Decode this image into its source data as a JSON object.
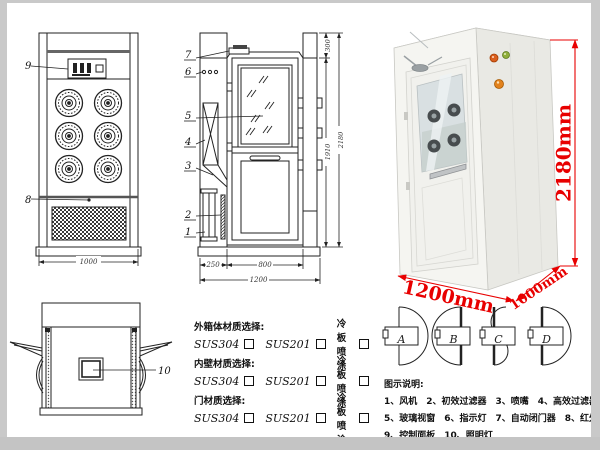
{
  "colors": {
    "red_dim": "#e80000",
    "line": "#222222",
    "frame_gray": "#c9c9c9",
    "glass": "#d9e0e2",
    "button_orange": "#d95f1e",
    "button_green": "#8fae3a",
    "button_amber": "#e2821d"
  },
  "callouts": {
    "c1": "1",
    "c2": "2",
    "c3": "3",
    "c4": "4",
    "c5": "5",
    "c6": "6",
    "c7": "7",
    "c8": "8",
    "c9": "9",
    "c10": "10"
  },
  "front_view": {
    "width_dim": "1000"
  },
  "section_view": {
    "top_dim": "300",
    "door_height_dim": "1910",
    "total_height_dim": "2180",
    "left_dim": "250",
    "door_width_dim": "800",
    "total_width_dim": "1200"
  },
  "photo": {
    "height_label": "2180mm",
    "width_label": "1200mm",
    "depth_label": "1000mm"
  },
  "materials": {
    "groups": [
      {
        "title": "外箱体材质选择:",
        "options": [
          "SUS304",
          "SUS201",
          "冷板喷涂"
        ]
      },
      {
        "title": "内壁材质选择:",
        "options": [
          "SUS304",
          "SUS201",
          "冷板喷涂"
        ]
      },
      {
        "title": "门材质选择:",
        "options": [
          "SUS304",
          "SUS201",
          "冷板喷涂"
        ]
      }
    ]
  },
  "door_types": {
    "a": "A",
    "b": "B",
    "c": "C",
    "d": "D"
  },
  "legend": {
    "title": "图示说明:",
    "rows": [
      [
        "1、风机",
        "2、初效过滤器",
        "3、喷嘴",
        "4、高效过滤器"
      ],
      [
        "5、玻璃视窗",
        "6、指示灯",
        "7、自动闭门器",
        "8、红外线感应器"
      ],
      [
        "9、控制面板",
        "10、照明灯"
      ]
    ]
  }
}
